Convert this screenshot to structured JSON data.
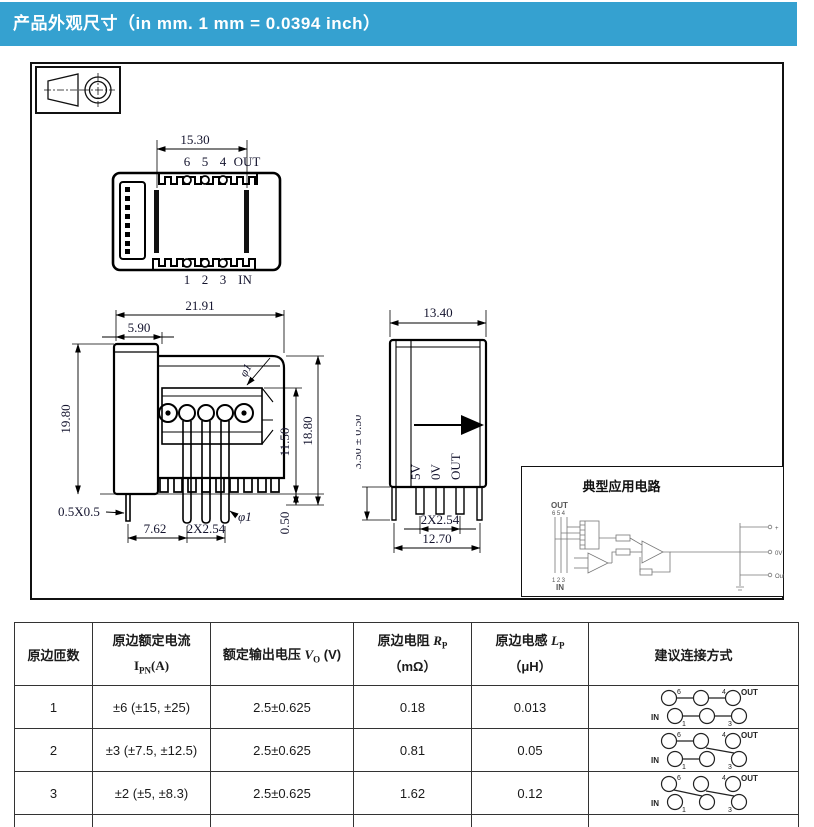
{
  "colors": {
    "header_bg": "#35a1d0",
    "ink": "#000000",
    "dim_text": "#14142e"
  },
  "header": {
    "title": "产品外观尺寸（in mm. 1 mm = 0.0394 inch）"
  },
  "drawing": {
    "top_view": {
      "dim_width": "15.30",
      "pins_top": [
        "6",
        "5",
        "4"
      ],
      "label_out": "OUT",
      "pins_bottom": [
        "1",
        "2",
        "3"
      ],
      "label_in": "IN"
    },
    "front_view": {
      "dim_total_width": "21.91",
      "dim_step_width": "5.90",
      "dim_height_left": "19.80",
      "dim_height_right": "18.80",
      "dim_inner_height": "11.50",
      "dim_standoff": "0.50",
      "dim_square_pin": "0.5X0.5",
      "dim_pitch_a": "7.62",
      "dim_pitch_b": "2X2.54",
      "dim_hole": "φ1",
      "dim_pin": "φ1"
    },
    "side_view": {
      "dim_width": "13.40",
      "dim_pin_len": "3.50 ± 0.50",
      "pin_labels": [
        "5V",
        "0V",
        "OUT"
      ],
      "dim_pitch": "2X2.54",
      "dim_bottom": "12.70"
    },
    "app_circuit": {
      "title": "典型应用电路",
      "label_out": "OUT",
      "pins_out": "654",
      "pins_in": "123",
      "label_in": "IN",
      "terminals": [
        "+",
        "0V",
        "Out"
      ]
    }
  },
  "table": {
    "headers": {
      "turns": "原边匝数",
      "current_line1": "原边额定电流",
      "current_sym": "I",
      "current_sub": "PN",
      "current_unit": "(A)",
      "voltage_line1": "额定输出电压",
      "voltage_sym": "V",
      "voltage_sub": "O",
      "voltage_unit": "(V)",
      "resistance_line1": "原边电阻",
      "resistance_sym": "R",
      "resistance_sub": "P",
      "resistance_unit": "（mΩ）",
      "inductance_line1": "原边电感",
      "inductance_sym": "L",
      "inductance_sub": "P",
      "inductance_unit": "（μH）",
      "connection": "建议连接方式"
    },
    "conn": {
      "out": "OUT",
      "in": "IN",
      "p6": "6",
      "p4": "4",
      "p1": "1",
      "p3": "3"
    },
    "rows": [
      {
        "turns": "1",
        "current": "±6 (±15, ±25)",
        "voltage": "2.5±0.625",
        "resistance": "0.18",
        "inductance": "0.013"
      },
      {
        "turns": "2",
        "current": "±3 (±7.5, ±12.5)",
        "voltage": "2.5±0.625",
        "resistance": "0.81",
        "inductance": "0.05"
      },
      {
        "turns": "3",
        "current": "±2 (±5, ±8.3)",
        "voltage": "2.5±0.625",
        "resistance": "1.62",
        "inductance": "0.12"
      }
    ]
  }
}
